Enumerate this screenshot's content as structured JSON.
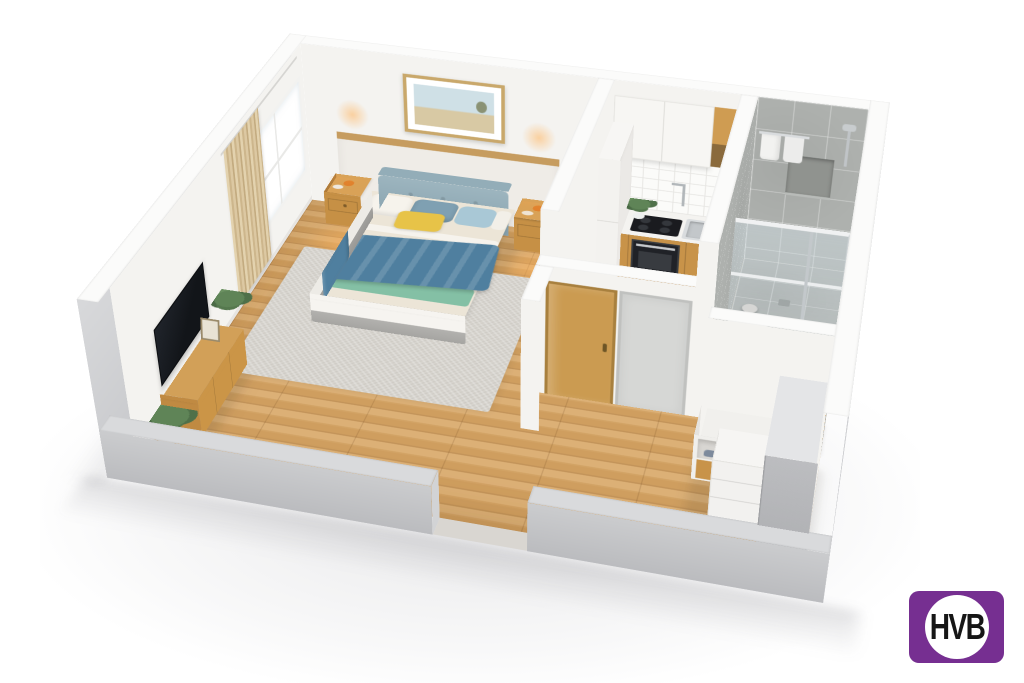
{
  "logo": {
    "text": "HVB",
    "badge_color": "#762f91",
    "circle_color": "#ffffff",
    "text_color": "#161616"
  },
  "scene": {
    "description": "3D isometric cutaway render of a furnished studio apartment floor plan on a white background",
    "rooms": [
      {
        "name": "bedroom",
        "furniture": [
          "double bed with blue blanket",
          "tufted headboard",
          "two wooden nightstands",
          "two table lamps",
          "gray rug",
          "wall-mounted tv",
          "wooden sideboard",
          "potted plants",
          "framed landscape picture",
          "window with beige curtain"
        ]
      },
      {
        "name": "kitchen",
        "furniture": [
          "white upper cabinets",
          "wood open shelf",
          "counter with sink and faucet",
          "black cooktop",
          "built-in oven",
          "tall white cabinet",
          "potted plant"
        ]
      },
      {
        "name": "bathroom",
        "furniture": [
          "tiled walk-in shower",
          "glass shower screen",
          "toilet",
          "towel rail with towels",
          "wooden ladder shelf",
          "shower head"
        ]
      },
      {
        "name": "entry-hall",
        "furniture": [
          "shoe cabinet with shoes",
          "white drawer dresser",
          "gray wardrobe",
          "wooden door",
          "gray door",
          "entrance threshold"
        ]
      }
    ],
    "palette": {
      "background": "#ffffff",
      "wall_white": "#f4f3f0",
      "wall_outer_gray": "#c9cacd",
      "wall_top": "#fbfbfa",
      "floor_wood": "#d3a365",
      "rug_gray": "#d6d3cd",
      "blanket_blue": "#4f7f9f",
      "sheet_teal": "#84c0a5",
      "pillow_yellow": "#e7c348",
      "pillow_blue": "#7fa0b2",
      "curtain_beige": "#d9c5a0",
      "cabinet_wood": "#c89349",
      "tile_gray": "#aeb1ae",
      "lamp_glow": "#ffb45e",
      "appliance_black": "#1d1f24",
      "wardrobe_gray": "#a7a8ab",
      "logo_purple": "#762f91"
    }
  }
}
